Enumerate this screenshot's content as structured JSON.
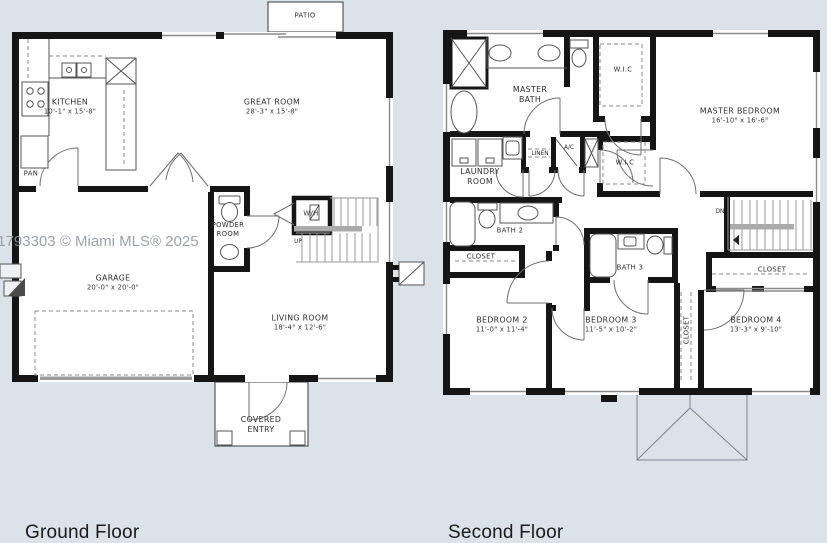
{
  "page": {
    "background": "#dce2e9",
    "watermark": "11793303 © Miami MLS® 2025",
    "ground_title": "Ground Floor",
    "second_title": "Second Floor"
  },
  "ground": {
    "patio": "PATIO",
    "kitchen": {
      "name": "KITCHEN",
      "dims": "10'-1\" x 15'-8\""
    },
    "great_room": {
      "name": "GREAT ROOM",
      "dims": "28'-3\" x 15'-8\""
    },
    "pantry": "PAN",
    "garage": {
      "name": "GARAGE",
      "dims": "20'-0\" x 20'-0\""
    },
    "powder_room": "POWDER ROOM",
    "water_heater": "W/H",
    "stairs_up": "UP",
    "living_room": {
      "name": "LIVING ROOM",
      "dims": "18'-4\" x 12'-6\""
    },
    "covered_entry": "COVERED ENTRY"
  },
  "second": {
    "master_bath": "MASTER BATH",
    "wic_top": "W.I.C",
    "wic_bottom": "W.I.C",
    "master_bedroom": {
      "name": "MASTER BEDROOM",
      "dims": "16'-10\" x 16'-6\""
    },
    "laundry_room": "LAUNDRY ROOM",
    "linen": "LINEN",
    "ac": "A/C",
    "bath2": "BATH 2",
    "closet_bedroom2": "CLOSET",
    "bedroom2": {
      "name": "BEDROOM 2",
      "dims": "11'-0\" x 11'-4\""
    },
    "bath3": "BATH 3",
    "bedroom3": {
      "name": "BEDROOM 3",
      "dims": "11'-5\" x 10'-2\""
    },
    "closet_hall": "CLOSET",
    "closet_bedroom4": "CLOSET",
    "bedroom4": {
      "name": "BEDROOM 4",
      "dims": "13'-3\" x 9'-10\""
    },
    "stairs_dn": "DN"
  }
}
